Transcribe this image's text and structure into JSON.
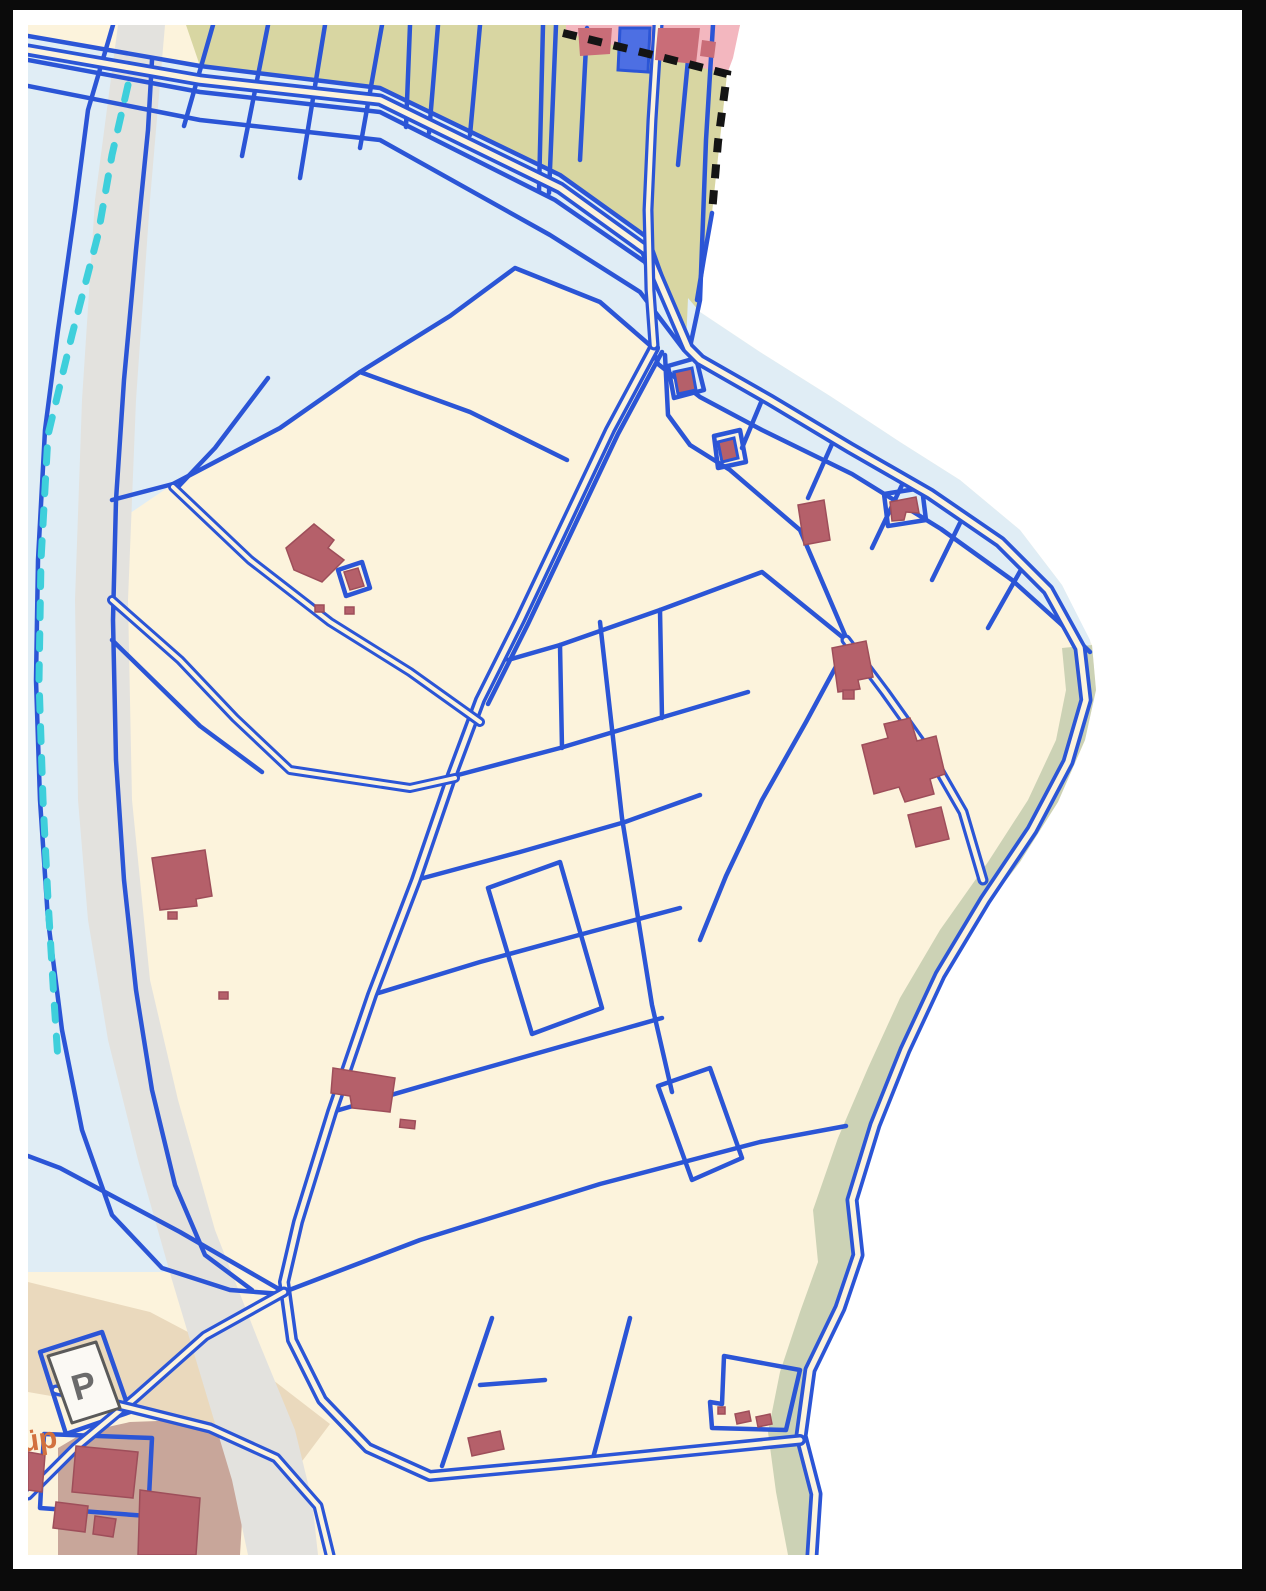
{
  "map": {
    "type": "cadastral-parcel-map",
    "labels": {
      "parking": "P",
      "street_partial": "üp"
    },
    "palette": {
      "frame": "#0b0b0b",
      "margin": "#ffffff",
      "outside": "#ffffff",
      "parcel-cream": "#fcf3dc",
      "field-khaki": "#d8d6a2",
      "water": "#e0edf5",
      "road-gray": "#e3e2de",
      "builtup-pink": "#f3b7bf",
      "building-red": "#b5606a",
      "building-red-dark": "#9e4e5a",
      "builtup-building": "#c96d78",
      "building-blue": "#4d6fe3",
      "line-blue": "#2b55d6",
      "coast-green": "#ccd2b5",
      "farmyard-brown": "#c8a69a",
      "tan": "#ead9bd",
      "stream-cyan": "#3ecfdb",
      "boundary-black": "#141414",
      "label-orange": "#d2713f",
      "icon-gray": "#6b6b6b",
      "icon-box": "#fbf9f4"
    }
  }
}
